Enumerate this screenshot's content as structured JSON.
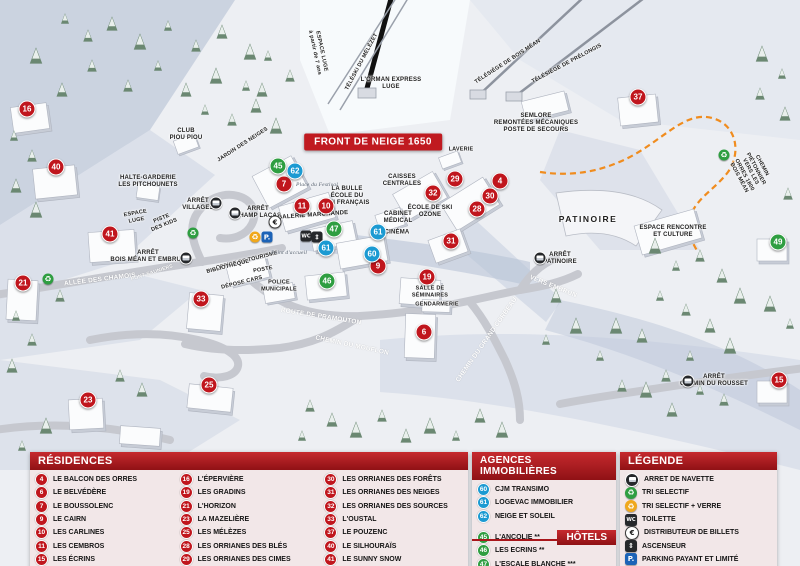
{
  "banner": "FRONT DE NEIGE 1650",
  "colors": {
    "residence_red": "#c0161d",
    "agence_blue": "#1b9ad2",
    "hotel_green": "#2f9e41",
    "header_red": "#b6191f",
    "parking_blue": "#1c63b7",
    "trail_orange": "#f08c1e"
  },
  "icon_glyphs": {
    "rec": "♻",
    "recy": "♻",
    "eur": "€",
    "wc": "WC",
    "lift": "⇕",
    "park": "P."
  },
  "map": {
    "markers": [
      {
        "n": "16",
        "type": "res",
        "x": 27,
        "y": 109
      },
      {
        "n": "40",
        "type": "res",
        "x": 56,
        "y": 167
      },
      {
        "n": "41",
        "type": "res",
        "x": 110,
        "y": 234
      },
      {
        "n": "21",
        "type": "res",
        "x": 23,
        "y": 283
      },
      {
        "n": "33",
        "type": "res",
        "x": 201,
        "y": 299
      },
      {
        "n": "23",
        "type": "res",
        "x": 88,
        "y": 400
      },
      {
        "n": "25",
        "type": "res",
        "x": 209,
        "y": 385
      },
      {
        "n": "15",
        "type": "res",
        "x": 779,
        "y": 380
      },
      {
        "n": "37",
        "type": "res",
        "x": 638,
        "y": 97
      },
      {
        "n": "7",
        "type": "res",
        "x": 284,
        "y": 184
      },
      {
        "n": "11",
        "type": "res",
        "x": 302,
        "y": 206
      },
      {
        "n": "10",
        "type": "res",
        "x": 326,
        "y": 206
      },
      {
        "n": "4",
        "type": "res",
        "x": 500,
        "y": 181
      },
      {
        "n": "29",
        "type": "res",
        "x": 455,
        "y": 179
      },
      {
        "n": "32",
        "type": "res",
        "x": 433,
        "y": 193
      },
      {
        "n": "30",
        "type": "res",
        "x": 490,
        "y": 196
      },
      {
        "n": "28",
        "type": "res",
        "x": 477,
        "y": 209
      },
      {
        "n": "31",
        "type": "res",
        "x": 451,
        "y": 241
      },
      {
        "n": "19",
        "type": "res",
        "x": 427,
        "y": 277
      },
      {
        "n": "6",
        "type": "res",
        "x": 424,
        "y": 332
      },
      {
        "n": "9",
        "type": "res",
        "x": 378,
        "y": 266
      },
      {
        "n": "62",
        "type": "agc",
        "x": 295,
        "y": 171
      },
      {
        "n": "61",
        "type": "agc",
        "x": 326,
        "y": 248
      },
      {
        "n": "61",
        "type": "agc",
        "x": 378,
        "y": 232
      },
      {
        "n": "60",
        "type": "agc",
        "x": 372,
        "y": 254
      },
      {
        "n": "45",
        "type": "htl",
        "x": 278,
        "y": 166
      },
      {
        "n": "47",
        "type": "htl",
        "x": 334,
        "y": 229
      },
      {
        "n": "46",
        "type": "htl",
        "x": 327,
        "y": 281
      },
      {
        "n": "49",
        "type": "htl",
        "x": 778,
        "y": 242
      }
    ],
    "labels": [
      {
        "t": "L'ORMAN EXPRESS\nLUGE",
        "x": 391,
        "y": 84
      },
      {
        "t": "ESPACE LUGE\nà partir de 7 ans",
        "x": 318,
        "y": 52,
        "r": 78,
        "cls": "sm"
      },
      {
        "t": "TÉLÉSKI DU MÉLÈZET",
        "x": 362,
        "y": 62,
        "r": -62,
        "cls": "sm"
      },
      {
        "t": "TÉLÉSIÈGE DE BOIS MÉAN",
        "x": 508,
        "y": 62,
        "r": -33,
        "cls": "sm"
      },
      {
        "t": "TÉLÉSIÈGE DE PRÉLONGIS",
        "x": 567,
        "y": 64,
        "r": -28,
        "cls": "sm"
      },
      {
        "t": "SEMLORE\nREMONTÉES MÉCANIQUES\nPOSTE DE SECOURS",
        "x": 536,
        "y": 124
      },
      {
        "t": "CLUB\nPIOU PIOU",
        "x": 186,
        "y": 135
      },
      {
        "t": "JARDIN DES NEIGES",
        "x": 243,
        "y": 145,
        "r": -33,
        "cls": "sm"
      },
      {
        "t": "HALTE-GARDERIE\nLES PITCHOUNETS",
        "x": 148,
        "y": 182
      },
      {
        "t": "ARRÊT\nVILLAGES",
        "x": 198,
        "y": 205
      },
      {
        "t": "ARRÊT\nCHAMP LACAS",
        "x": 258,
        "y": 213
      },
      {
        "t": "ESPACE\nLUGE",
        "x": 136,
        "y": 217,
        "r": -10,
        "cls": "sm"
      },
      {
        "t": "PISTE\nDES KIDS",
        "x": 163,
        "y": 222,
        "r": -22,
        "cls": "sm"
      },
      {
        "t": "CAISSES\nCENTRALES",
        "x": 402,
        "y": 181
      },
      {
        "t": "LA BULLE\nÉCOLE DU\nSKI FRANÇAIS",
        "x": 347,
        "y": 197
      },
      {
        "t": "Place du Festival",
        "x": 317,
        "y": 185,
        "cls": "it"
      },
      {
        "t": "GALERIE MARCHANDE",
        "x": 313,
        "y": 216,
        "r": -4
      },
      {
        "t": "CABINET\nMÉDICAL",
        "x": 398,
        "y": 218
      },
      {
        "t": "CINÉMA",
        "x": 397,
        "y": 233
      },
      {
        "t": "LAVERIE",
        "x": 461,
        "y": 150,
        "cls": "sm"
      },
      {
        "t": "ÉCOLE DE SKI\nOZONE",
        "x": 430,
        "y": 212
      },
      {
        "t": "OFFICE DE TOURISME",
        "x": 247,
        "y": 261,
        "r": -14,
        "cls": "sm"
      },
      {
        "t": "BIBLIOTHÈQUE",
        "x": 228,
        "y": 267,
        "r": -14,
        "cls": "sm"
      },
      {
        "t": "POSTE",
        "x": 263,
        "y": 270,
        "r": -10,
        "cls": "sm"
      },
      {
        "t": "DÉPOSE CARS",
        "x": 242,
        "y": 283,
        "r": -14,
        "cls": "sm"
      },
      {
        "t": "POLICE\nMUNICIPALE",
        "x": 279,
        "y": 286,
        "cls": "sm"
      },
      {
        "t": "Point d'accueil",
        "x": 289,
        "y": 253,
        "cls": "it"
      },
      {
        "t": "ARRÊT\nBOIS MÉAN ET EMBRUN",
        "x": 148,
        "y": 257
      },
      {
        "t": "PONT SAUNIERS",
        "x": 152,
        "y": 273,
        "r": -18,
        "cls": "roadsm"
      },
      {
        "t": "ALLÉE DES CHAMOIS",
        "x": 100,
        "y": 280,
        "r": -7,
        "cls": "road"
      },
      {
        "t": "ROUTE DE PRAMOUTON",
        "x": 321,
        "y": 317,
        "r": 9,
        "cls": "road"
      },
      {
        "t": "CHEMIN DU MOUFLON",
        "x": 352,
        "y": 346,
        "r": 12,
        "cls": "road"
      },
      {
        "t": "CHEMIN DU GRAND CORBEAU",
        "x": 487,
        "y": 340,
        "r": -55,
        "cls": "road"
      },
      {
        "t": "VERS EMBRUN",
        "x": 553,
        "y": 287,
        "r": 22,
        "cls": "road"
      },
      {
        "t": "PATINOIRE",
        "x": 588,
        "y": 219,
        "cls": "big"
      },
      {
        "t": "ESPACE RENCONTRE\nET CULTURE",
        "x": 673,
        "y": 232
      },
      {
        "t": "ARRÊT\nPATINOIRE",
        "x": 560,
        "y": 259
      },
      {
        "t": "SALLE DE\nSÉMINAIRES",
        "x": 430,
        "y": 292,
        "cls": "sm"
      },
      {
        "t": "GENDARMERIE",
        "x": 437,
        "y": 305,
        "cls": "sm"
      },
      {
        "t": "CHEMIN PIÉTONNIER\nVERS LES ORRES 1800\nBOIS MÉAN",
        "x": 750,
        "y": 172,
        "r": 62,
        "cls": "sm"
      },
      {
        "t": "ARRÊT\nCHEMIN DU ROUSSET",
        "x": 714,
        "y": 381
      }
    ],
    "icons": [
      {
        "k": "bus",
        "x": 216,
        "y": 203
      },
      {
        "k": "bus",
        "x": 235,
        "y": 213
      },
      {
        "k": "bus",
        "x": 186,
        "y": 258
      },
      {
        "k": "bus",
        "x": 540,
        "y": 258
      },
      {
        "k": "bus",
        "x": 688,
        "y": 381
      },
      {
        "k": "rec",
        "x": 193,
        "y": 233
      },
      {
        "k": "rec",
        "x": 48,
        "y": 279
      },
      {
        "k": "rec",
        "x": 724,
        "y": 155
      },
      {
        "k": "recy",
        "x": 255,
        "y": 237
      },
      {
        "k": "park",
        "x": 267,
        "y": 237
      },
      {
        "k": "eur",
        "x": 275,
        "y": 222
      },
      {
        "k": "wc",
        "x": 306,
        "y": 236
      },
      {
        "k": "lift",
        "x": 317,
        "y": 237
      }
    ]
  },
  "panels": {
    "residences": {
      "title": "RÉSIDENCES",
      "items": [
        {
          "n": "4",
          "label": "LE BALCON DES ORRES"
        },
        {
          "n": "6",
          "label": "LE BELVÉDÈRE"
        },
        {
          "n": "7",
          "label": "LE BOUSSOLENC"
        },
        {
          "n": "9",
          "label": "LE CAIRN"
        },
        {
          "n": "10",
          "label": "LES CARLINES"
        },
        {
          "n": "11",
          "label": "LES CEMBROS"
        },
        {
          "n": "15",
          "label": "LES ÉCRINS"
        },
        {
          "n": "16",
          "label": "L'ÉPERVIÈRE"
        },
        {
          "n": "19",
          "label": "LES GRADINS"
        },
        {
          "n": "21",
          "label": "L'HORIZON"
        },
        {
          "n": "23",
          "label": "LA MAZELIÈRE"
        },
        {
          "n": "25",
          "label": "LES MÉLÈZES"
        },
        {
          "n": "28",
          "label": "LES ORRIANES DES BLÉS"
        },
        {
          "n": "29",
          "label": "LES ORRIANES DES CIMES"
        },
        {
          "n": "30",
          "label": "LES ORRIANES DES FORÊTS"
        },
        {
          "n": "31",
          "label": "LES ORRIANES DES NEIGES"
        },
        {
          "n": "32",
          "label": "LES ORRIANES DES SOURCES"
        },
        {
          "n": "33",
          "label": "L'OUSTAL"
        },
        {
          "n": "37",
          "label": "LE POUZENC"
        },
        {
          "n": "40",
          "label": "LE SILHOURAÏS"
        },
        {
          "n": "41",
          "label": "LE SUNNY SNOW"
        }
      ]
    },
    "agences": {
      "title": "AGENCES IMMOBILIÈRES",
      "items": [
        {
          "n": "60",
          "label": "CJM TRANSIMO"
        },
        {
          "n": "61",
          "label": "LOGEVAC IMMOBILIER"
        },
        {
          "n": "62",
          "label": "NEIGE ET SOLEIL"
        }
      ]
    },
    "hotels": {
      "title": "HÔTELS",
      "items": [
        {
          "n": "45",
          "label": "L'ANCOLIE **"
        },
        {
          "n": "46",
          "label": "LES ECRINS **"
        },
        {
          "n": "47",
          "label": "L'ESCALE BLANCHE ***"
        },
        {
          "n": "49",
          "label": "LES TRAPPEURS **"
        }
      ]
    },
    "legende": {
      "title": "LÉGENDE",
      "items": [
        {
          "icon": "bus",
          "label": "ARRET DE NAVETTE"
        },
        {
          "icon": "rec",
          "label": "TRI SELECTIF"
        },
        {
          "icon": "recy",
          "label": "TRI SELECTIF + VERRE"
        },
        {
          "icon": "wc",
          "label": "TOILETTE"
        },
        {
          "icon": "eur",
          "label": "DISTRIBUTEUR DE BILLETS"
        },
        {
          "icon": "lift",
          "label": "ASCENSEUR"
        },
        {
          "icon": "park",
          "label": "PARKING PAYANT ET LIMITÉ"
        }
      ]
    }
  }
}
